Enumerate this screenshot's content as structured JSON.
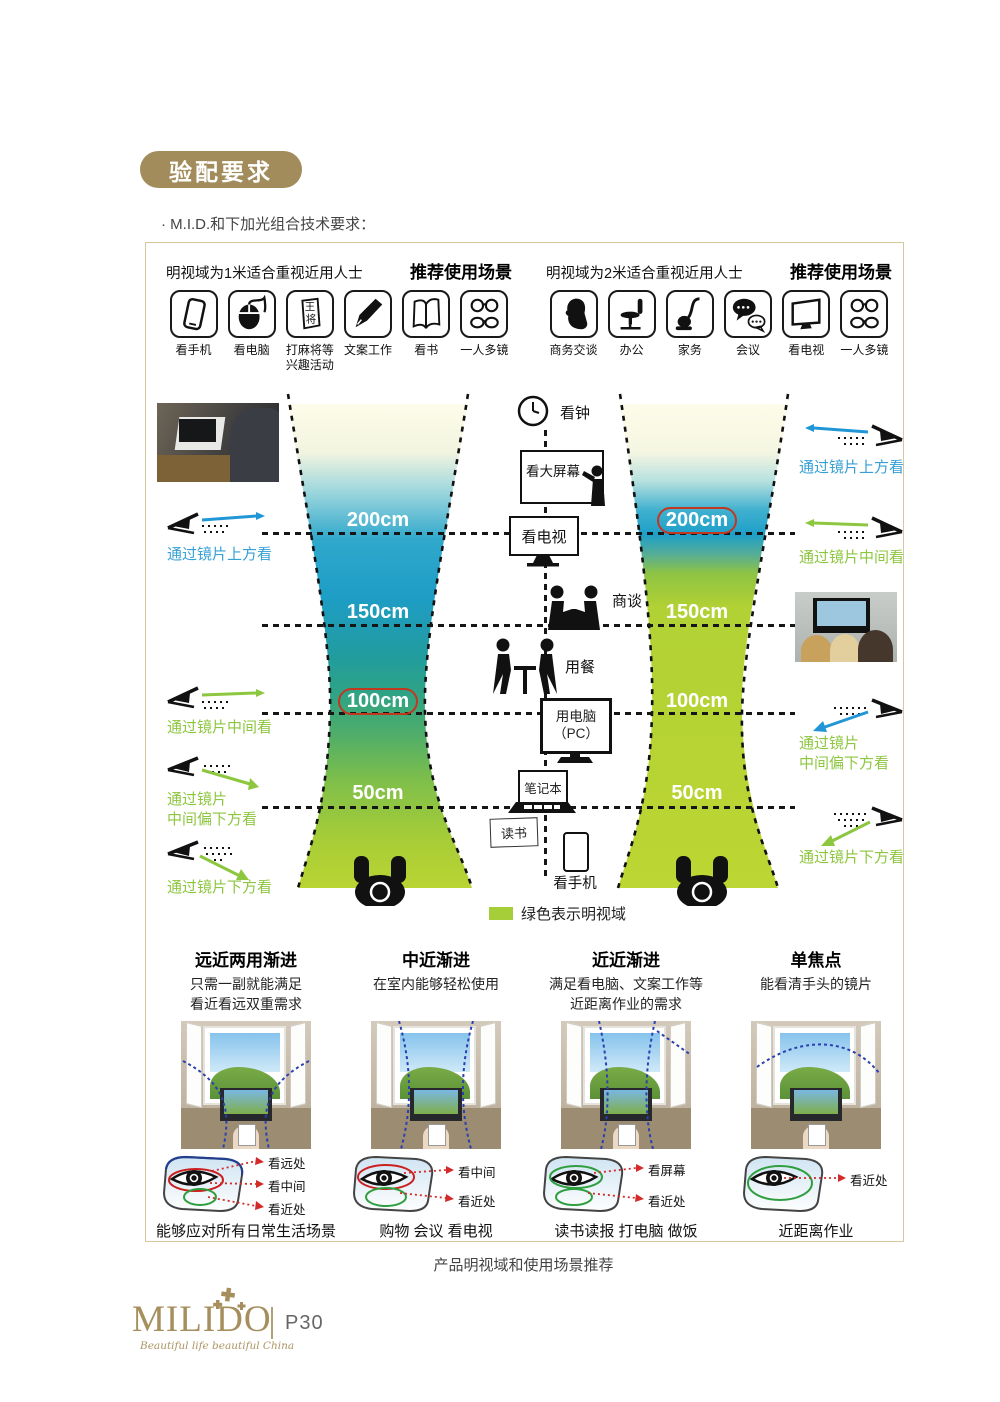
{
  "header": {
    "badge": "验配要求",
    "subtitle": "· M.I.D.和下加光组合技术要求："
  },
  "panels": [
    {
      "title": "明视域为1米适合重视近用人士",
      "scene_header": "推荐使用场景",
      "icons": [
        {
          "icon": "phone-icon",
          "label": "看手机"
        },
        {
          "icon": "mouse-icon",
          "label": "看电脑"
        },
        {
          "icon": "mahjong-icon",
          "label": "打麻将等\n兴趣活动",
          "glyphs": [
            "王",
            "将"
          ]
        },
        {
          "icon": "pen-icon",
          "label": "文案工作"
        },
        {
          "icon": "book-icon",
          "label": "看书"
        },
        {
          "icon": "glasses-icon",
          "label": "一人多镜"
        }
      ]
    },
    {
      "title": "明视域为2米适合重视近用人士",
      "scene_header": "推荐使用场景",
      "icons": [
        {
          "icon": "profile-icon",
          "label": "商务交谈"
        },
        {
          "icon": "chair-icon",
          "label": "办公"
        },
        {
          "icon": "vacuum-icon",
          "label": "家务"
        },
        {
          "icon": "chat-icon",
          "label": "会议"
        },
        {
          "icon": "tv-icon",
          "label": "看电视"
        },
        {
          "icon": "glasses-icon",
          "label": "一人多镜"
        }
      ]
    }
  ],
  "diagram": {
    "left_scale": {
      "labels": [
        "200cm",
        "150cm",
        "100cm",
        "50cm"
      ],
      "circled": "100cm"
    },
    "right_scale": {
      "labels": [
        "200cm",
        "150cm",
        "100cm",
        "50cm"
      ],
      "circled": "200cm"
    },
    "center_items": [
      "看钟",
      "看大屏幕",
      "看电视",
      "商谈",
      "用餐",
      "用电脑\n（PC）",
      "笔记本",
      "读书",
      "看手机"
    ],
    "left_annotations": [
      "通过镜片上方看",
      "通过镜片中间看",
      "通过镜片\n中间偏下方看",
      "通过镜片下方看"
    ],
    "right_annotations": [
      "通过镜片上方看",
      "通过镜片中间看",
      "通过镜片\n中间偏下方看",
      "通过镜片下方看"
    ],
    "legend": {
      "text": "绿色表示明视域",
      "color": "#a6ce39"
    }
  },
  "lens_columns": [
    {
      "title": "远近两用渐进",
      "desc": "只需一副就能满足\n看近看远双重需求",
      "labels": [
        "看远处",
        "看中间",
        "看近处"
      ],
      "ring_colors": [
        "#23408f",
        "#cc2020",
        "#2f9e3f"
      ],
      "caption": "能够应对所有日常生活场景"
    },
    {
      "title": "中近渐进",
      "desc": "在室内能够轻松使用",
      "labels": [
        "看中间",
        "看近处"
      ],
      "ring_colors": [
        "#cc2020",
        "#2f9e3f"
      ],
      "caption": "购物 会议 看电视"
    },
    {
      "title": "近近渐进",
      "desc": "满足看电脑、文案工作等\n近距离作业的需求",
      "labels": [
        "看屏幕",
        "看近处"
      ],
      "ring_colors": [
        "#2f9e3f",
        "#2f9e3f"
      ],
      "caption": "读书读报 打电脑 做饭"
    },
    {
      "title": "单焦点",
      "desc": "能看清手头的镜片",
      "labels": [
        "看近处"
      ],
      "ring_colors": [
        "#2f9e3f"
      ],
      "caption": "近距离作业"
    }
  ],
  "caption": "产品明视域和使用场景推荐",
  "footer": {
    "logo": "MILIDO",
    "tagline": "Beautiful life beautiful China",
    "page": "P30"
  },
  "colors": {
    "accent_gold": "#a28c5b",
    "blue": "#36a0d6",
    "green": "#8dc63f",
    "highlight_red": "#c2371f",
    "legend_green": "#a6ce39"
  }
}
